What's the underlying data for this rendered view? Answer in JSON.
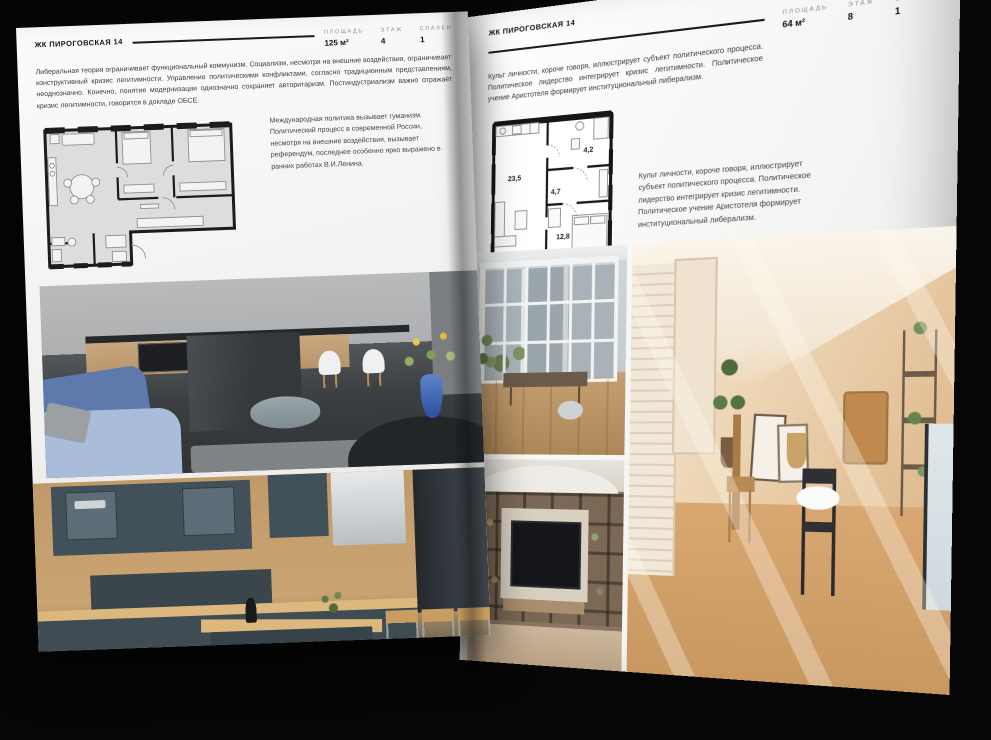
{
  "palette": {
    "background": "#060606",
    "page": "#f6f6f4",
    "rule": "#1c1c1c",
    "label_gray": "#8d8d8d",
    "body_text": "#3c3c3c",
    "plan_wall": "#1c1c1e",
    "plan_fill_left": "#dedddc",
    "sofa_blue": "#5e79ab",
    "vase_blue": "#3d66b5",
    "kitchen_wood": "#c49a67",
    "cabinet_slate": "#42505a",
    "tan_room": "#e3c29b"
  },
  "left_page": {
    "title": "ЖК ПИРОГОВСКАЯ 14",
    "stats": [
      {
        "label": "ПЛОЩАДЬ",
        "value": "125 м²"
      },
      {
        "label": "ЭТАЖ",
        "value": "4"
      },
      {
        "label": "СПАЛЕН",
        "value": "1"
      }
    ],
    "body": "Либеральная теория ограничивает функциональный коммунизм. Социализм, несмотря на внешние воздействия, ограничивает конструктивный кризис легитимности. Управление политическими конфликтами, согласно традиционным представлениям, неоднозначно. Конечно, понятие модернизации однозначно сохраняет авторитаризм. Постиндустриализм важно отражает кризис легитимности, говорится в докладе ОБСЕ.",
    "caption": "Международная политика вызывает гуманизм. Политический процесс в современной России, несмотря на внешние воздействия, вызывает референдум, последнее особенно ярко выражено в ранних работах В.И.Ленина.",
    "photos": [
      {
        "name": "kitchen-island-living-room"
      },
      {
        "name": "wood-and-slate-kitchen"
      }
    ]
  },
  "right_page": {
    "title": "ЖК ПИРОГОВСКАЯ 14",
    "stats": [
      {
        "label": "ПЛОЩАДЬ",
        "value": "64 м²"
      },
      {
        "label": "ЭТАЖ",
        "value": "8"
      },
      {
        "label": "СПАЛЕН",
        "value": "1"
      }
    ],
    "body": "Культ личности, короче говоря, иллюстрирует субъект политического процесса. Политическое лидерство интегрирует кризис легитимности. Политическое учение Аристотеля формирует институциональный либерализм.",
    "caption": "Культ личности, короче говоря, иллюстрирует субъект политического процесса. Политическое лидерство интегрирует кризис легитимности. Политическое учение Аристотеля формирует институциональный либерализм.",
    "floor_plan": {
      "areas": [
        "23,5",
        "4,7",
        "4,2",
        "12,8"
      ]
    },
    "photos": [
      {
        "name": "loft-window-room"
      },
      {
        "name": "attic-sunlit-room"
      },
      {
        "name": "shelving-tv-room"
      }
    ]
  }
}
